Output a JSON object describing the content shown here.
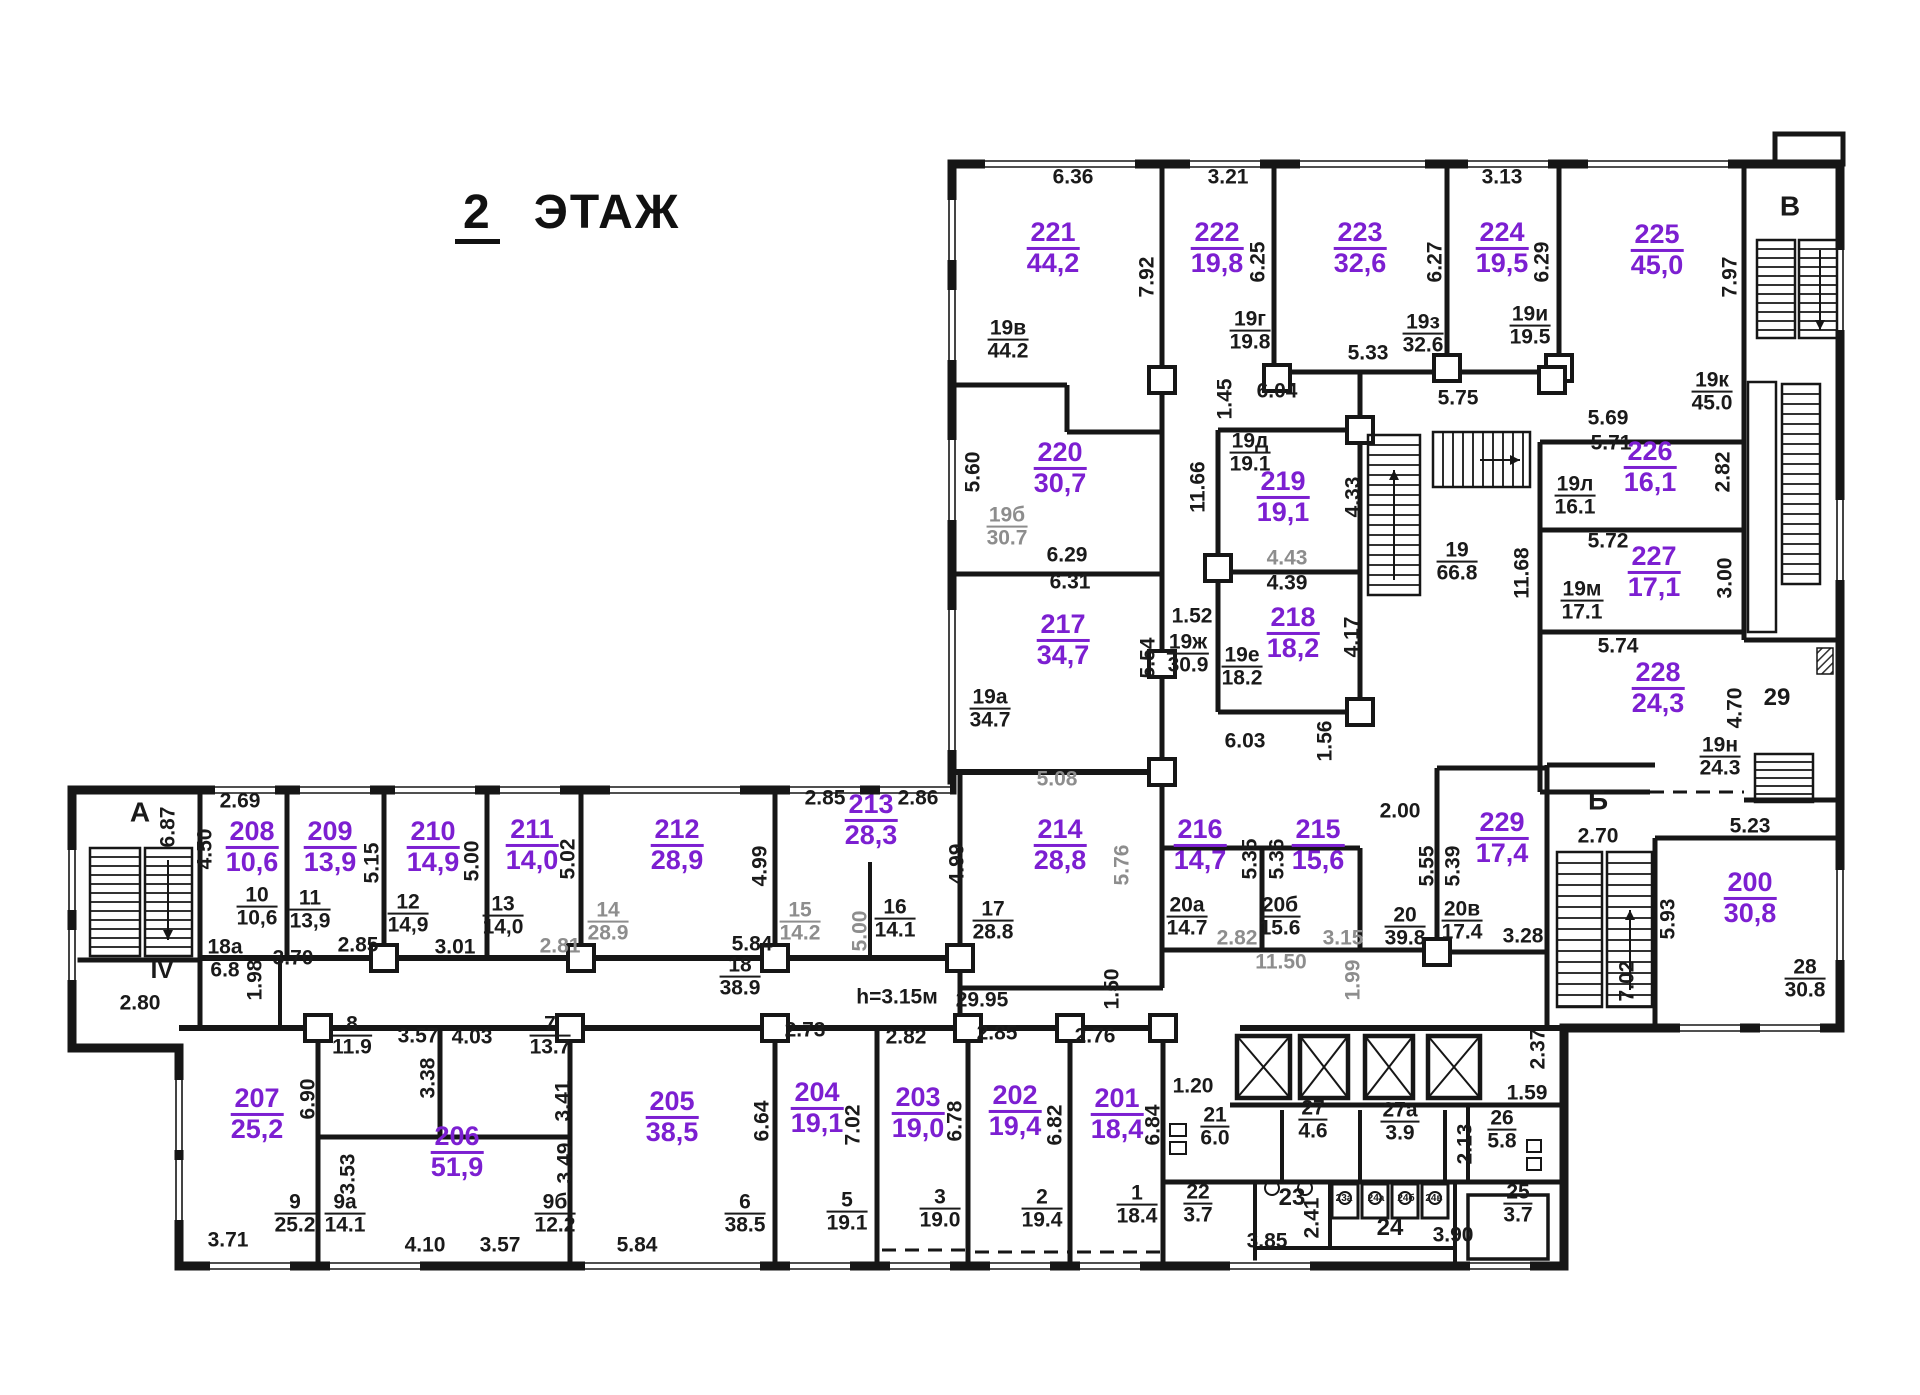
{
  "title": {
    "number": "2",
    "label": "ЭТАЖ"
  },
  "colors": {
    "room_accent": "#7c1fd1",
    "ink": "#1a1a1a",
    "muted": "#8d8d8d"
  },
  "rooms": [
    {
      "number": "221",
      "area": "44,2",
      "x": 1053,
      "y": 248
    },
    {
      "number": "222",
      "area": "19,8",
      "x": 1217,
      "y": 248
    },
    {
      "number": "223",
      "area": "32,6",
      "x": 1360,
      "y": 248
    },
    {
      "number": "224",
      "area": "19,5",
      "x": 1502,
      "y": 248
    },
    {
      "number": "225",
      "area": "45,0",
      "x": 1657,
      "y": 250
    },
    {
      "number": "220",
      "area": "30,7",
      "x": 1060,
      "y": 468
    },
    {
      "number": "219",
      "area": "19,1",
      "x": 1283,
      "y": 497
    },
    {
      "number": "218",
      "area": "18,2",
      "x": 1293,
      "y": 633
    },
    {
      "number": "217",
      "area": "34,7",
      "x": 1063,
      "y": 640
    },
    {
      "number": "226",
      "area": "16,1",
      "x": 1650,
      "y": 467
    },
    {
      "number": "227",
      "area": "17,1",
      "x": 1654,
      "y": 572
    },
    {
      "number": "228",
      "area": "24,3",
      "x": 1658,
      "y": 688
    },
    {
      "number": "229",
      "area": "17,4",
      "x": 1502,
      "y": 838
    },
    {
      "number": "200",
      "area": "30,8",
      "x": 1750,
      "y": 898
    },
    {
      "number": "216",
      "area": "14,7",
      "x": 1200,
      "y": 845
    },
    {
      "number": "215",
      "area": "15,6",
      "x": 1318,
      "y": 845
    },
    {
      "number": "214",
      "area": "28,8",
      "x": 1060,
      "y": 845
    },
    {
      "number": "213",
      "area": "28,3",
      "x": 871,
      "y": 820
    },
    {
      "number": "212",
      "area": "28,9",
      "x": 677,
      "y": 845
    },
    {
      "number": "211",
      "area": "14,0",
      "x": 532,
      "y": 845
    },
    {
      "number": "210",
      "area": "14,9",
      "x": 433,
      "y": 847
    },
    {
      "number": "209",
      "area": "13,9",
      "x": 330,
      "y": 847
    },
    {
      "number": "208",
      "area": "10,6",
      "x": 252,
      "y": 847
    },
    {
      "number": "207",
      "area": "25,2",
      "x": 257,
      "y": 1114
    },
    {
      "number": "206",
      "area": "51,9",
      "x": 457,
      "y": 1152
    },
    {
      "number": "205",
      "area": "38,5",
      "x": 672,
      "y": 1117
    },
    {
      "number": "204",
      "area": "19,1",
      "x": 817,
      "y": 1108
    },
    {
      "number": "203",
      "area": "19,0",
      "x": 918,
      "y": 1113
    },
    {
      "number": "202",
      "area": "19,4",
      "x": 1015,
      "y": 1111
    },
    {
      "number": "201",
      "area": "18,4",
      "x": 1117,
      "y": 1114
    }
  ],
  "units": [
    {
      "top": "19в",
      "bottom": "44.2",
      "x": 1008,
      "y": 340
    },
    {
      "top": "19г",
      "bottom": "19.8",
      "x": 1250,
      "y": 331
    },
    {
      "top": "19з",
      "bottom": "32.6",
      "x": 1423,
      "y": 334
    },
    {
      "top": "19и",
      "bottom": "19.5",
      "x": 1530,
      "y": 326
    },
    {
      "top": "19к",
      "bottom": "45.0",
      "x": 1712,
      "y": 392
    },
    {
      "top": "19б",
      "bottom": "30.7",
      "x": 1007,
      "y": 527,
      "muted": true
    },
    {
      "top": "19д",
      "bottom": "19.1",
      "x": 1250,
      "y": 453
    },
    {
      "top": "19л",
      "bottom": "16.1",
      "x": 1575,
      "y": 496
    },
    {
      "top": "19м",
      "bottom": "17.1",
      "x": 1582,
      "y": 601
    },
    {
      "top": "19н",
      "bottom": "24.3",
      "x": 1720,
      "y": 757
    },
    {
      "top": "19а",
      "bottom": "34.7",
      "x": 990,
      "y": 709
    },
    {
      "top": "19ж",
      "bottom": "30.9",
      "x": 1188,
      "y": 654
    },
    {
      "top": "19е",
      "bottom": "18.2",
      "x": 1242,
      "y": 667
    },
    {
      "top": "19",
      "bottom": "66.8",
      "x": 1457,
      "y": 562
    },
    {
      "top": "10",
      "bottom": "10,6",
      "x": 257,
      "y": 907
    },
    {
      "top": "11",
      "bottom": "13,9",
      "x": 310,
      "y": 910
    },
    {
      "top": "12",
      "bottom": "14,9",
      "x": 408,
      "y": 914
    },
    {
      "top": "13",
      "bottom": "14,0",
      "x": 503,
      "y": 916
    },
    {
      "top": "14",
      "bottom": "28.9",
      "x": 608,
      "y": 922,
      "muted": true
    },
    {
      "top": "15",
      "bottom": "14.2",
      "x": 800,
      "y": 922,
      "muted": true
    },
    {
      "top": "16",
      "bottom": "14.1",
      "x": 895,
      "y": 919
    },
    {
      "top": "17",
      "bottom": "28.8",
      "x": 993,
      "y": 921
    },
    {
      "top": "18",
      "bottom": "38.9",
      "x": 740,
      "y": 977
    },
    {
      "top": "18а",
      "bottom": "6.8",
      "x": 225,
      "y": 959
    },
    {
      "top": "20а",
      "bottom": "14.7",
      "x": 1187,
      "y": 917
    },
    {
      "top": "20б",
      "bottom": "15.6",
      "x": 1280,
      "y": 917
    },
    {
      "top": "20",
      "bottom": "39.8",
      "x": 1405,
      "y": 927
    },
    {
      "top": "20в",
      "bottom": "17.4",
      "x": 1462,
      "y": 921
    },
    {
      "top": "28",
      "bottom": "30.8",
      "x": 1805,
      "y": 979
    },
    {
      "top": "9",
      "bottom": "25.2",
      "x": 295,
      "y": 1214
    },
    {
      "top": "9а",
      "bottom": "14.1",
      "x": 345,
      "y": 1214
    },
    {
      "top": "9б",
      "bottom": "12.2",
      "x": 555,
      "y": 1214
    },
    {
      "top": "8",
      "bottom": "11.9",
      "x": 352,
      "y": 1036
    },
    {
      "top": "7",
      "bottom": "13.7",
      "x": 550,
      "y": 1036
    },
    {
      "top": "6",
      "bottom": "38.5",
      "x": 745,
      "y": 1214
    },
    {
      "top": "5",
      "bottom": "19.1",
      "x": 847,
      "y": 1212
    },
    {
      "top": "3",
      "bottom": "19.0",
      "x": 940,
      "y": 1209
    },
    {
      "top": "2",
      "bottom": "19.4",
      "x": 1042,
      "y": 1209
    },
    {
      "top": "1",
      "bottom": "18.4",
      "x": 1137,
      "y": 1205
    },
    {
      "top": "21",
      "bottom": "6.0",
      "x": 1215,
      "y": 1127
    },
    {
      "top": "27",
      "bottom": "4.6",
      "x": 1313,
      "y": 1120
    },
    {
      "top": "27а",
      "bottom": "3.9",
      "x": 1400,
      "y": 1122
    },
    {
      "top": "26",
      "bottom": "5.8",
      "x": 1502,
      "y": 1130
    },
    {
      "top": "22",
      "bottom": "3.7",
      "x": 1198,
      "y": 1204
    },
    {
      "top": "25",
      "bottom": "3.7",
      "x": 1518,
      "y": 1204
    }
  ],
  "dims": [
    {
      "text": "6.36",
      "x": 1073,
      "y": 177
    },
    {
      "text": "3.21",
      "x": 1228,
      "y": 177
    },
    {
      "text": "3.13",
      "x": 1502,
      "y": 177
    },
    {
      "text": "7.92",
      "x": 1147,
      "y": 277,
      "v": true
    },
    {
      "text": "6.25",
      "x": 1258,
      "y": 262,
      "v": true
    },
    {
      "text": "6.27",
      "x": 1435,
      "y": 262,
      "v": true
    },
    {
      "text": "6.29",
      "x": 1542,
      "y": 262,
      "v": true
    },
    {
      "text": "7.97",
      "x": 1730,
      "y": 277,
      "v": true
    },
    {
      "text": "5.33",
      "x": 1368,
      "y": 353
    },
    {
      "text": "6.04",
      "x": 1277,
      "y": 391
    },
    {
      "text": "1.45",
      "x": 1225,
      "y": 399,
      "v": true
    },
    {
      "text": "5.75",
      "x": 1458,
      "y": 398
    },
    {
      "text": "5.69",
      "x": 1608,
      "y": 418
    },
    {
      "text": "5.71",
      "x": 1611,
      "y": 443
    },
    {
      "text": "5.60",
      "x": 973,
      "y": 472,
      "v": true
    },
    {
      "text": "6.29",
      "x": 1067,
      "y": 555
    },
    {
      "text": "6.31",
      "x": 1070,
      "y": 582
    },
    {
      "text": "11.66",
      "x": 1198,
      "y": 487,
      "v": true
    },
    {
      "text": "4.33",
      "x": 1353,
      "y": 497,
      "v": true
    },
    {
      "text": "2.82",
      "x": 1723,
      "y": 472,
      "v": true
    },
    {
      "text": "5.72",
      "x": 1608,
      "y": 541
    },
    {
      "text": "3.00",
      "x": 1725,
      "y": 578,
      "v": true
    },
    {
      "text": "4.43",
      "x": 1287,
      "y": 558,
      "muted": true
    },
    {
      "text": "4.39",
      "x": 1287,
      "y": 583
    },
    {
      "text": "1.52",
      "x": 1192,
      "y": 616
    },
    {
      "text": "4.17",
      "x": 1352,
      "y": 637,
      "v": true
    },
    {
      "text": "5.54",
      "x": 1148,
      "y": 658,
      "v": true
    },
    {
      "text": "11.68",
      "x": 1522,
      "y": 573,
      "v": true
    },
    {
      "text": "5.74",
      "x": 1618,
      "y": 646
    },
    {
      "text": "4.70",
      "x": 1735,
      "y": 708,
      "v": true
    },
    {
      "text": "6.03",
      "x": 1245,
      "y": 741
    },
    {
      "text": "1.56",
      "x": 1325,
      "y": 741,
      "v": true
    },
    {
      "text": "2.00",
      "x": 1400,
      "y": 811
    },
    {
      "text": "5.23",
      "x": 1750,
      "y": 826
    },
    {
      "text": "2.70",
      "x": 1598,
      "y": 836
    },
    {
      "text": "5.93",
      "x": 1668,
      "y": 919,
      "v": true
    },
    {
      "text": "7.02",
      "x": 1627,
      "y": 981,
      "v": true
    },
    {
      "text": "5.08",
      "x": 1057,
      "y": 779,
      "muted": true
    },
    {
      "text": "2.85",
      "x": 825,
      "y": 798
    },
    {
      "text": "2.86",
      "x": 918,
      "y": 798
    },
    {
      "text": "2.69",
      "x": 240,
      "y": 801
    },
    {
      "text": "6.87",
      "x": 168,
      "y": 827,
      "v": true
    },
    {
      "text": "4.50",
      "x": 205,
      "y": 849,
      "v": true
    },
    {
      "text": "5.15",
      "x": 372,
      "y": 863,
      "v": true
    },
    {
      "text": "5.00",
      "x": 472,
      "y": 861,
      "v": true
    },
    {
      "text": "5.02",
      "x": 568,
      "y": 859,
      "v": true
    },
    {
      "text": "4.99",
      "x": 760,
      "y": 866,
      "v": true
    },
    {
      "text": "4.99",
      "x": 957,
      "y": 864,
      "v": true
    },
    {
      "text": "5.76",
      "x": 1122,
      "y": 865,
      "v": true,
      "muted": true
    },
    {
      "text": "5.35",
      "x": 1250,
      "y": 859,
      "v": true
    },
    {
      "text": "5.36",
      "x": 1277,
      "y": 859,
      "v": true
    },
    {
      "text": "5.55",
      "x": 1427,
      "y": 866,
      "v": true
    },
    {
      "text": "5.39",
      "x": 1453,
      "y": 866,
      "v": true
    },
    {
      "text": "2.85",
      "x": 358,
      "y": 945
    },
    {
      "text": "3.01",
      "x": 455,
      "y": 947
    },
    {
      "text": "2.81",
      "x": 560,
      "y": 946,
      "muted": true
    },
    {
      "text": "5.84",
      "x": 752,
      "y": 944
    },
    {
      "text": "5.00",
      "x": 860,
      "y": 931,
      "v": true,
      "muted": true
    },
    {
      "text": "2.82",
      "x": 1237,
      "y": 938,
      "muted": true
    },
    {
      "text": "3.15",
      "x": 1343,
      "y": 938,
      "muted": true
    },
    {
      "text": "3.28",
      "x": 1523,
      "y": 936
    },
    {
      "text": "11.50",
      "x": 1281,
      "y": 962,
      "muted": true
    },
    {
      "text": "1.99",
      "x": 1353,
      "y": 980,
      "v": true,
      "muted": true
    },
    {
      "text": "3.70",
      "x": 293,
      "y": 958
    },
    {
      "text": "1.98",
      "x": 255,
      "y": 980,
      "v": true
    },
    {
      "text": "2.80",
      "x": 140,
      "y": 1003
    },
    {
      "text": "h=3.15м",
      "x": 897,
      "y": 997
    },
    {
      "text": "29.95",
      "x": 982,
      "y": 1000
    },
    {
      "text": "1.50",
      "x": 1112,
      "y": 989,
      "v": true
    },
    {
      "text": "2.73",
      "x": 805,
      "y": 1030
    },
    {
      "text": "2.82",
      "x": 906,
      "y": 1037
    },
    {
      "text": "2.85",
      "x": 997,
      "y": 1033
    },
    {
      "text": "2.76",
      "x": 1095,
      "y": 1036
    },
    {
      "text": "1.20",
      "x": 1193,
      "y": 1086
    },
    {
      "text": "2.37",
      "x": 1538,
      "y": 1049,
      "v": true
    },
    {
      "text": "1.59",
      "x": 1527,
      "y": 1093
    },
    {
      "text": "2.13",
      "x": 1465,
      "y": 1144,
      "v": true
    },
    {
      "text": "3.57",
      "x": 418,
      "y": 1036
    },
    {
      "text": "4.03",
      "x": 472,
      "y": 1037
    },
    {
      "text": "3.38",
      "x": 428,
      "y": 1078,
      "v": true
    },
    {
      "text": "3.41",
      "x": 563,
      "y": 1101,
      "v": true
    },
    {
      "text": "3.49",
      "x": 565,
      "y": 1163,
      "v": true
    },
    {
      "text": "3.53",
      "x": 348,
      "y": 1174,
      "v": true
    },
    {
      "text": "6.90",
      "x": 308,
      "y": 1099,
      "v": true
    },
    {
      "text": "6.64",
      "x": 762,
      "y": 1121,
      "v": true
    },
    {
      "text": "7.02",
      "x": 853,
      "y": 1125,
      "v": true
    },
    {
      "text": "6.78",
      "x": 955,
      "y": 1121,
      "v": true
    },
    {
      "text": "6.82",
      "x": 1055,
      "y": 1125,
      "v": true
    },
    {
      "text": "6.84",
      "x": 1153,
      "y": 1125,
      "v": true
    },
    {
      "text": "2.41",
      "x": 1312,
      "y": 1218,
      "v": true
    },
    {
      "text": "3.85",
      "x": 1267,
      "y": 1241
    },
    {
      "text": "3.90",
      "x": 1453,
      "y": 1235
    },
    {
      "text": "3.71",
      "x": 228,
      "y": 1240
    },
    {
      "text": "4.10",
      "x": 425,
      "y": 1245
    },
    {
      "text": "3.57",
      "x": 500,
      "y": 1245
    },
    {
      "text": "5.84",
      "x": 637,
      "y": 1245
    }
  ],
  "marks": [
    {
      "text": "А",
      "x": 140,
      "y": 813,
      "size": 28
    },
    {
      "text": "Б",
      "x": 1598,
      "y": 801,
      "size": 28
    },
    {
      "text": "В",
      "x": 1790,
      "y": 207,
      "size": 28
    },
    {
      "text": "IV",
      "x": 162,
      "y": 971,
      "size": 24
    },
    {
      "text": "29",
      "x": 1777,
      "y": 698,
      "size": 24
    },
    {
      "text": "23",
      "x": 1292,
      "y": 1198,
      "size": 24
    },
    {
      "text": "24",
      "x": 1390,
      "y": 1228,
      "size": 24
    },
    {
      "text": "23а",
      "x": 1344,
      "y": 1199,
      "size": 10
    },
    {
      "text": "24а",
      "x": 1376,
      "y": 1199,
      "size": 10
    },
    {
      "text": "24б",
      "x": 1406,
      "y": 1199,
      "size": 10
    },
    {
      "text": "24в",
      "x": 1434,
      "y": 1199,
      "size": 10
    }
  ]
}
